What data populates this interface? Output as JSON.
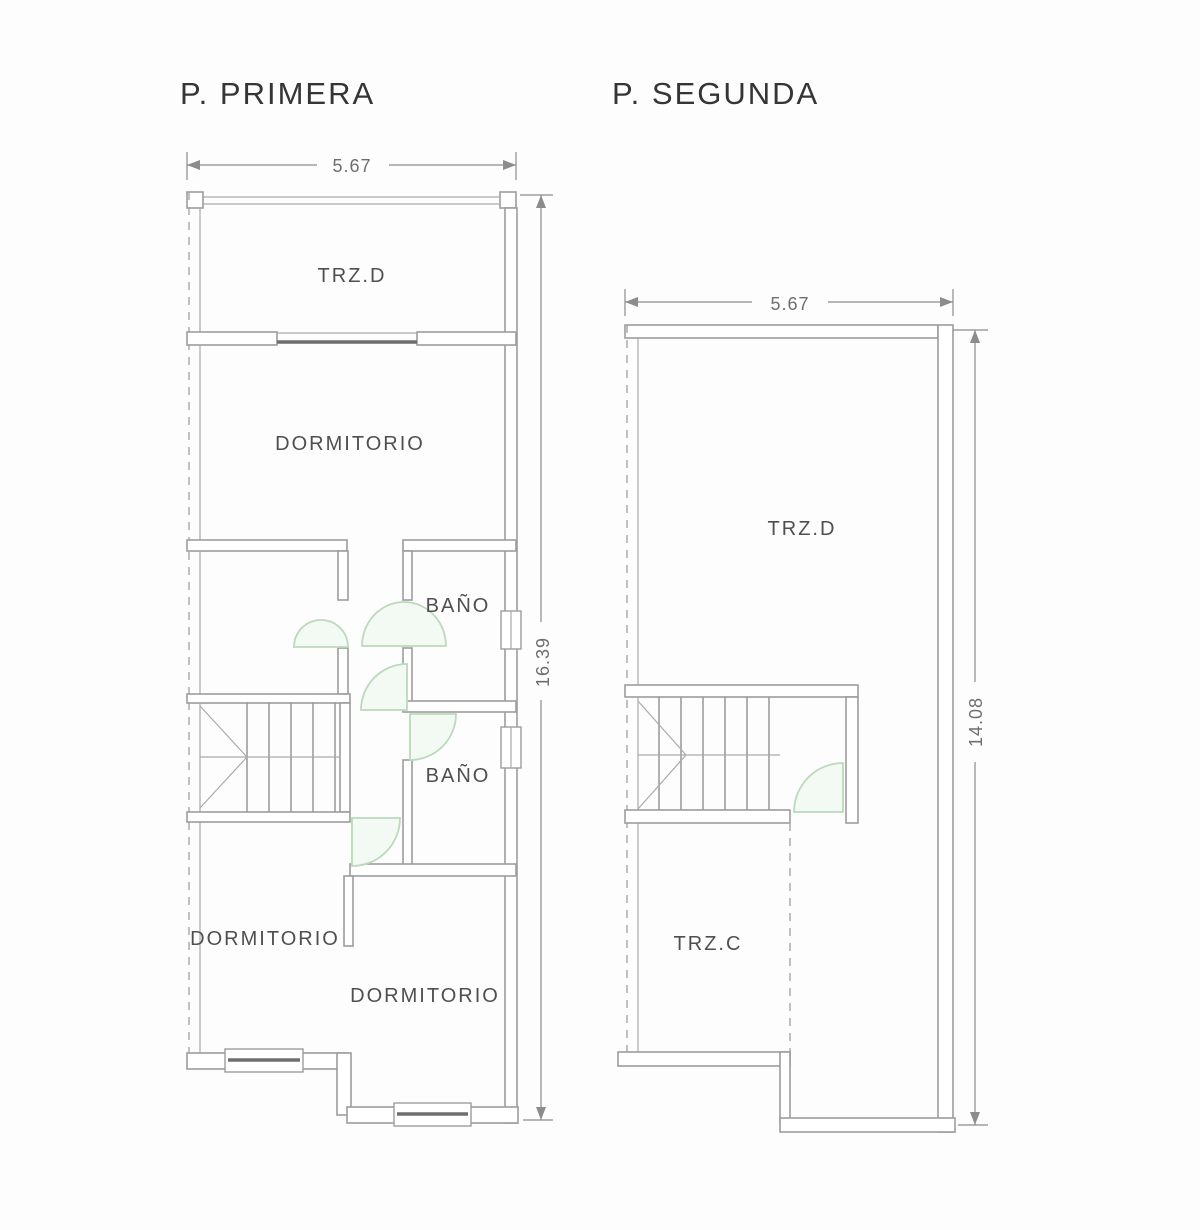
{
  "colors": {
    "background": "#fdfdfd",
    "wall_line": "#9d9d9d",
    "glass_dark_line": "#6e6e6e",
    "door_swing_stroke": "#bcd9bc",
    "door_swing_fill": "#f3f9f3",
    "dimension_line": "#8c8c8c",
    "label_text": "#4f4f4f",
    "title_text": "#353535"
  },
  "plans": {
    "primera": {
      "title": "P. PRIMERA",
      "dims": {
        "width": "5.67",
        "height": "16.39"
      },
      "rooms": {
        "terrace_top": "TRZ.D",
        "bedroom_top": "DORMITORIO",
        "bath_upper": "BAÑO",
        "bath_lower": "BAÑO",
        "bedroom_bottom_left": "DORMITORIO",
        "bedroom_bottom_right": "DORMITORIO"
      }
    },
    "segunda": {
      "title": "P. SEGUNDA",
      "dims": {
        "width": "5.67",
        "height": "14.08"
      },
      "rooms": {
        "terrace_top": "TRZ.D",
        "terrace_bottom": "TRZ.C"
      }
    }
  }
}
